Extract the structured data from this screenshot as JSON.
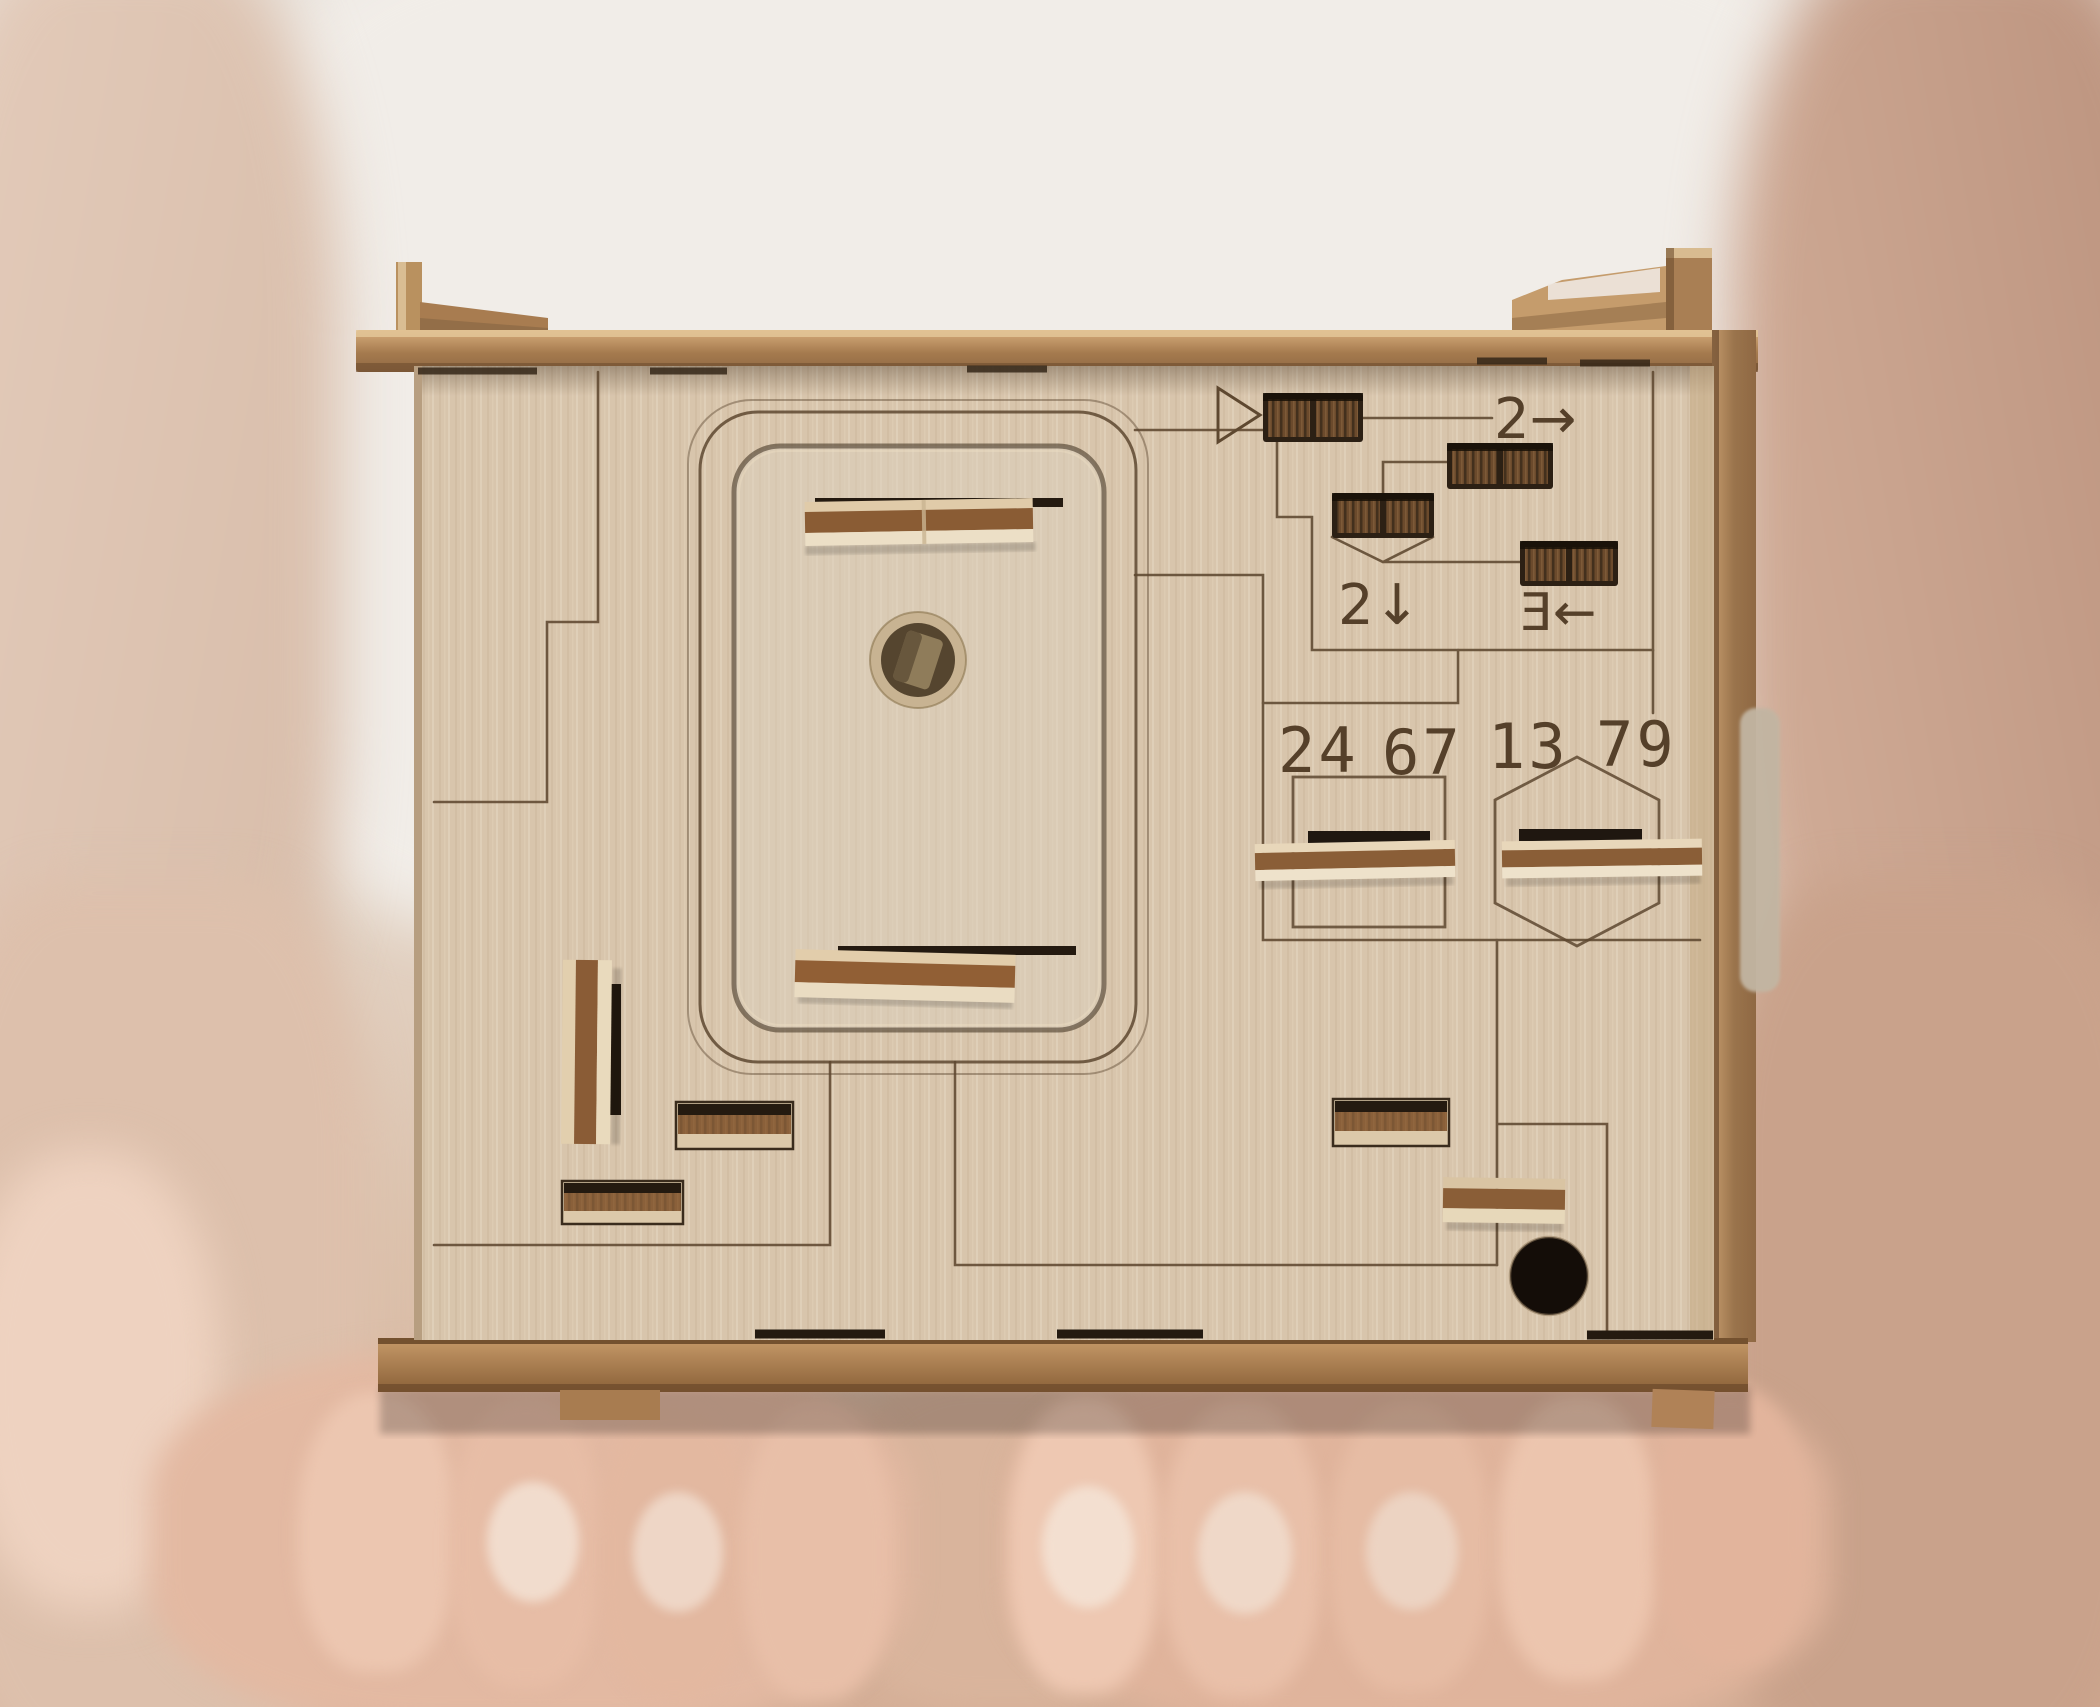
{
  "scene": {
    "subject": "Two hands holding a laser-cut wooden puzzle box with sliders, engraved circuit-maze lines, number windows and instruction arrows",
    "setting": "blurred person in white top, warm neutral background"
  },
  "box": {
    "engraved_numbers": {
      "pair_1": "24",
      "pair_2": "67",
      "pair_3": "13",
      "pair_4": "79"
    },
    "instructions": {
      "slide_right": "2→",
      "slide_down": "2↓",
      "slide_left": "Ǝ←"
    },
    "icons": {
      "start_marker": "right-pointing-triangle-outline",
      "number_frame_left": "rectangle-outline",
      "number_frame_right": "hexagon-outline",
      "door_peg_hole": "round-hole-with-square-peg",
      "corner_hole": "round-dark-hole"
    },
    "colors": {
      "panel_wood": "#d8c5ac",
      "door_recess_wood": "#dacbb5",
      "rail_wood": "#a97e52",
      "rail_highlight": "#d7ad7c",
      "engraving": "#5e4830",
      "slot_recess": "#241a10",
      "slider_knurl": "#6b4a2c",
      "handle_brown": "#8a5e37",
      "handle_light": "#e8d7ba",
      "hole_dark": "#140d08",
      "skin": "#e6bda6",
      "blouse": "#f1ede8"
    }
  }
}
